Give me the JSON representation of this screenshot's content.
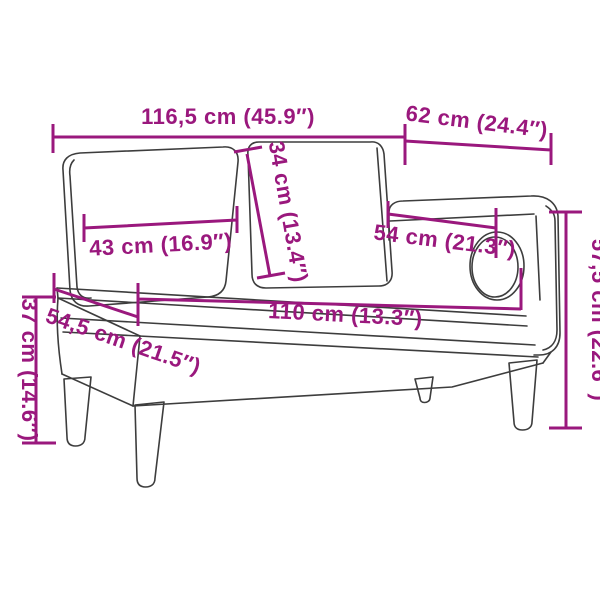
{
  "diagram": {
    "accent_color": "#9a187d",
    "line_color": "#3d3d3d",
    "subject": "chaise-lounge-with-cushions-line-drawing",
    "dimensions": {
      "overall_length": {
        "label": "116,5 cm (45.9″)"
      },
      "arm_section_length": {
        "label": "62 cm (24.4″)"
      },
      "back_cushion_height": {
        "label": "34 cm (13.4″)"
      },
      "back_cushion_width": {
        "label": "43 cm (16.9″)"
      },
      "armrest_length": {
        "label": "54 cm (21.3″)"
      },
      "seat_length": {
        "label": "110 cm (13.3″)"
      },
      "overall_height": {
        "label": "57,5 cm (22.6″)"
      },
      "seat_height": {
        "label": "37 cm (14.6″)"
      },
      "seat_depth": {
        "label": "54,5 cm (21.5″)"
      }
    }
  }
}
